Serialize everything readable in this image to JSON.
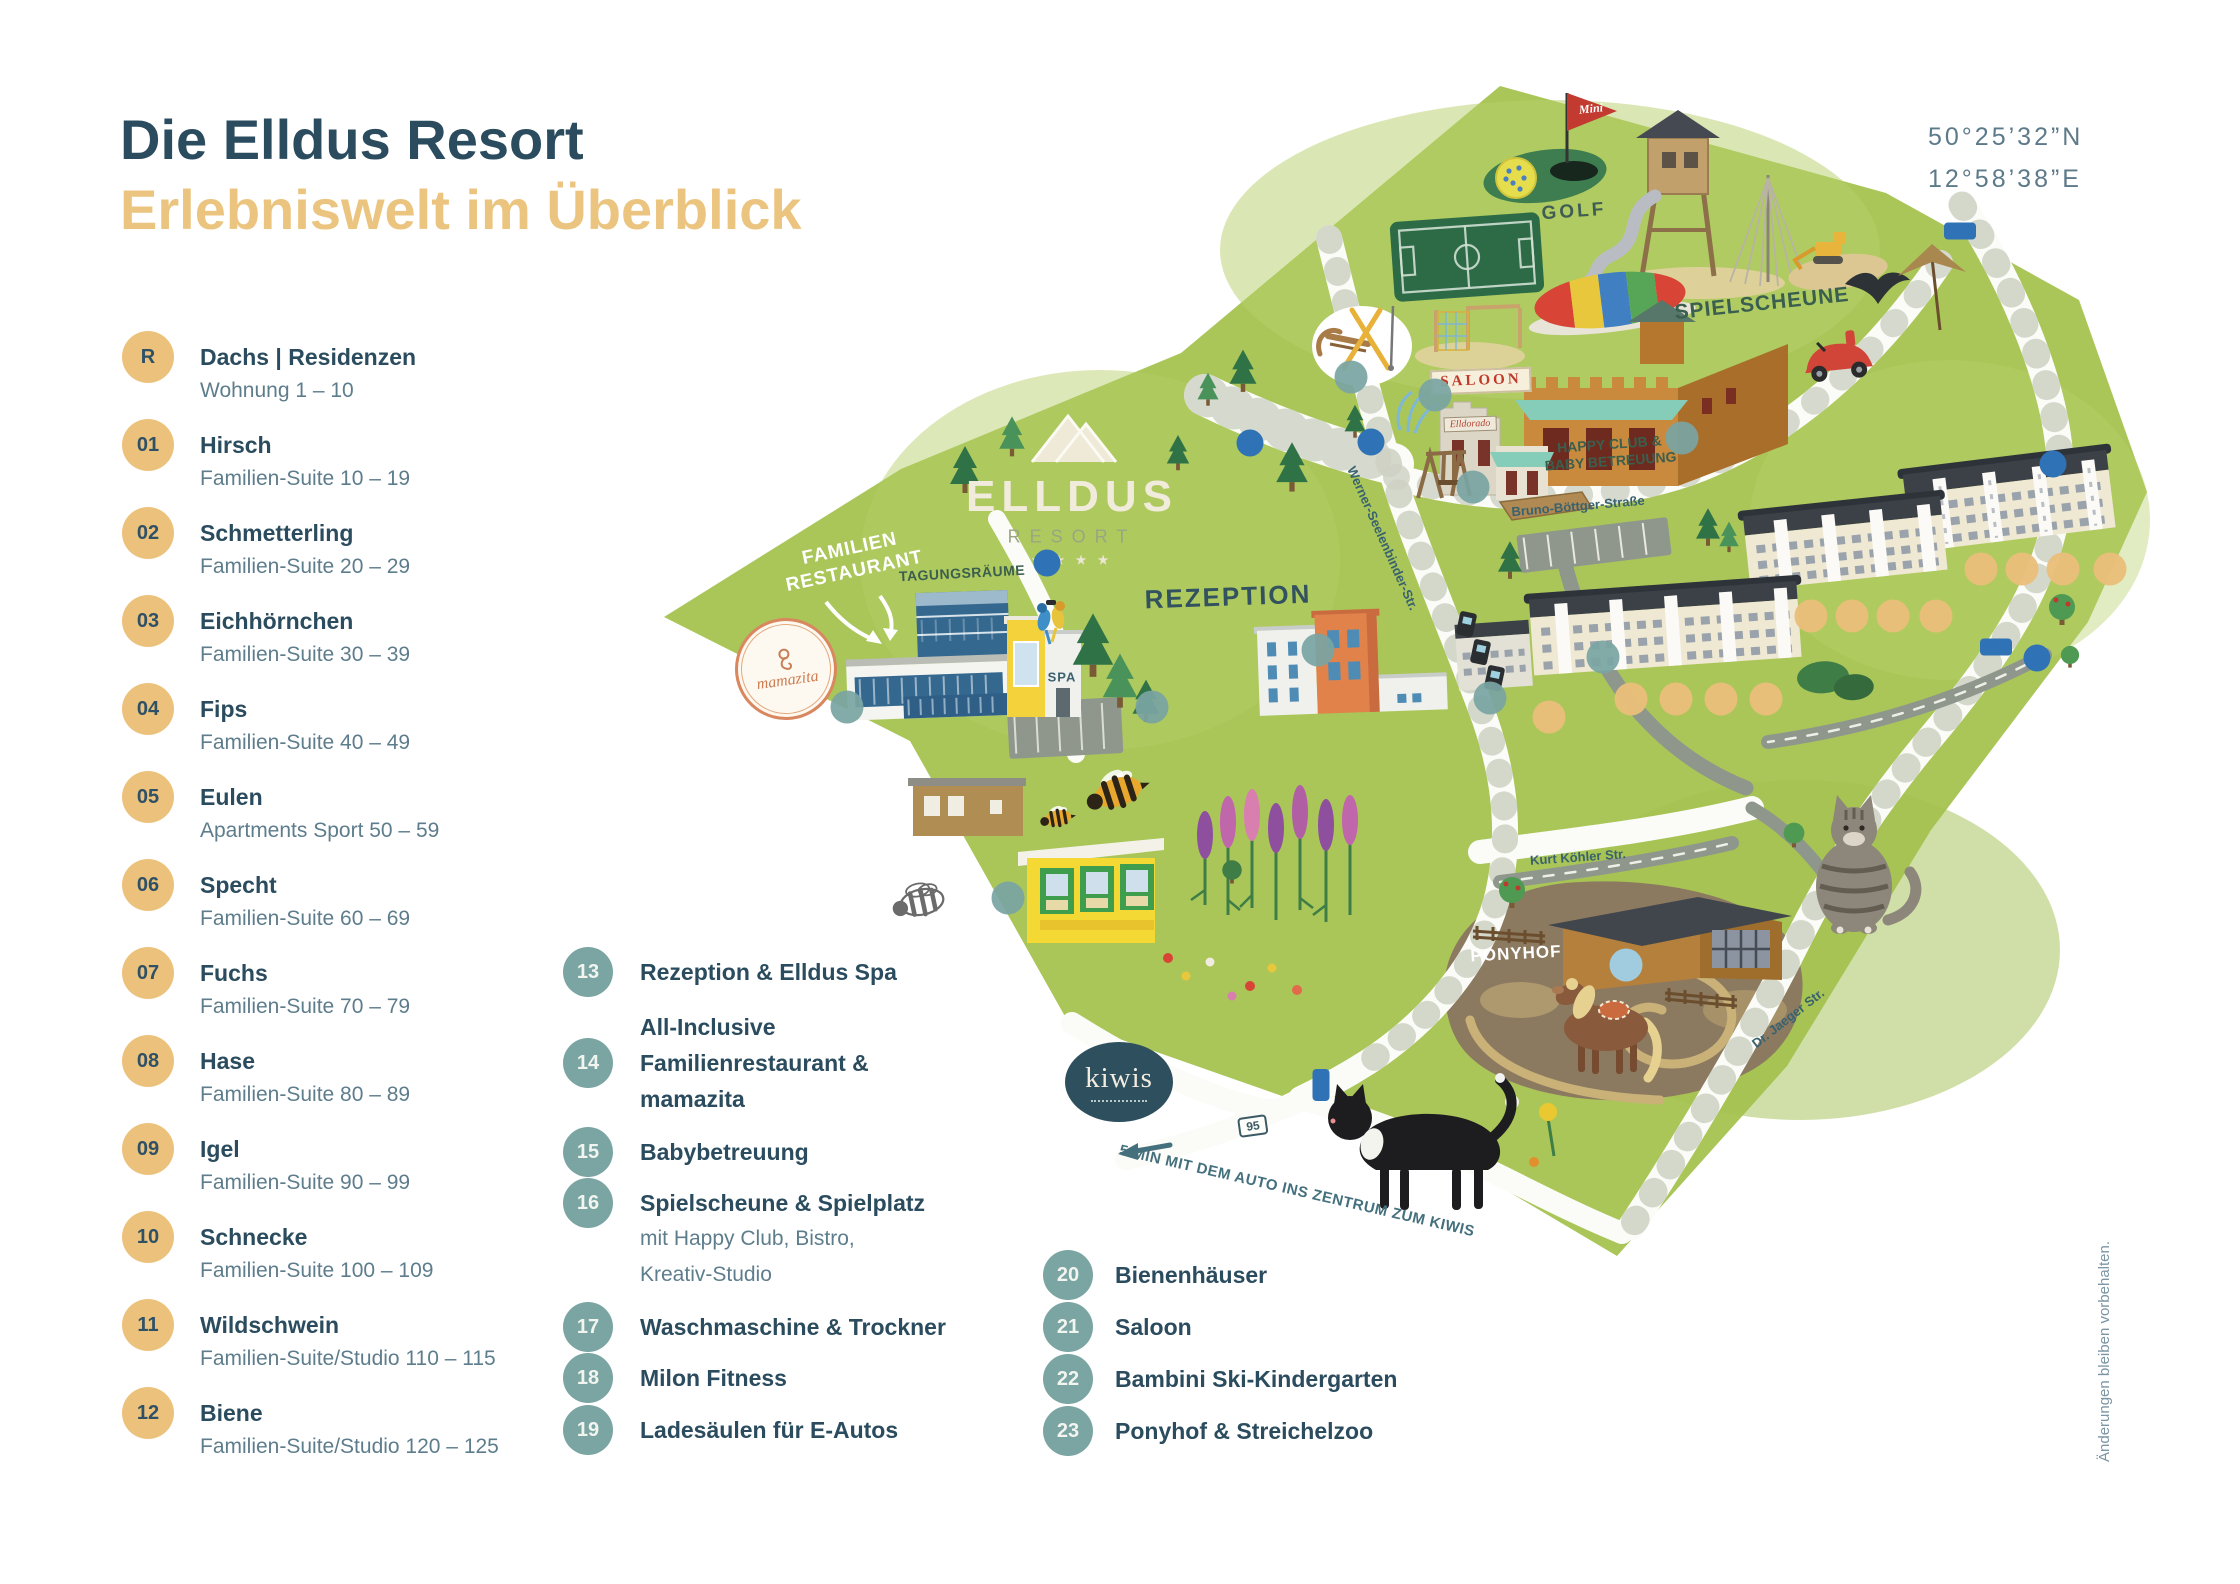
{
  "title": {
    "line1": "Die Elldus Resort",
    "line2": "Erlebniswelt im Überblick"
  },
  "coordinates": {
    "lat": "50°25’32”N",
    "lon": "12°58’38”E"
  },
  "footnote": "Änderungen bleiben vorbehalten.",
  "legend_rooms": [
    {
      "id": "R",
      "name": "Dachs | Residenzen",
      "sub": "Wohnung 1 – 10"
    },
    {
      "id": "01",
      "name": "Hirsch",
      "sub": "Familien-Suite 10 – 19"
    },
    {
      "id": "02",
      "name": "Schmetterling",
      "sub": "Familien-Suite 20 – 29"
    },
    {
      "id": "03",
      "name": "Eichhörnchen",
      "sub": "Familien-Suite 30 – 39"
    },
    {
      "id": "04",
      "name": "Fips",
      "sub": "Familien-Suite 40 – 49"
    },
    {
      "id": "05",
      "name": "Eulen",
      "sub": "Apartments Sport 50 – 59"
    },
    {
      "id": "06",
      "name": "Specht",
      "sub": "Familien-Suite 60 – 69"
    },
    {
      "id": "07",
      "name": "Fuchs",
      "sub": "Familien-Suite 70 – 79"
    },
    {
      "id": "08",
      "name": "Hase",
      "sub": "Familien-Suite 80 – 89"
    },
    {
      "id": "09",
      "name": "Igel",
      "sub": "Familien-Suite 90 – 99"
    },
    {
      "id": "10",
      "name": "Schnecke",
      "sub": "Familien-Suite 100 – 109"
    },
    {
      "id": "11",
      "name": "Wildschwein",
      "sub": "Familien-Suite/Studio 110 – 115"
    },
    {
      "id": "12",
      "name": "Biene",
      "sub": "Familien-Suite/Studio 120 – 125"
    }
  ],
  "legend_facilities": [
    {
      "id": "13",
      "lines": [
        "Rezeption & Elldus Spa"
      ]
    },
    {
      "id": "14",
      "lines": [
        "All-Inclusive",
        "Familienrestaurant &",
        "mamazita"
      ]
    },
    {
      "id": "15",
      "lines": [
        "Babybetreuung"
      ]
    },
    {
      "id": "16",
      "lines": [
        "Spielscheune & Spielplatz"
      ],
      "sublines": [
        "mit Happy Club, Bistro,",
        "Kreativ-Studio"
      ],
      "align": "first"
    },
    {
      "id": "17",
      "lines": [
        "Waschmaschine & Trockner"
      ]
    },
    {
      "id": "18",
      "lines": [
        "Milon Fitness"
      ]
    },
    {
      "id": "19",
      "lines": [
        "Ladesäulen für E-Autos"
      ]
    }
  ],
  "legend_points": [
    {
      "id": "20",
      "name": "Bienenhäuser"
    },
    {
      "id": "21",
      "name": "Saloon"
    },
    {
      "id": "22",
      "name": "Bambini Ski-Kindergarten"
    },
    {
      "id": "23",
      "name": "Ponyhof & Streichelzoo"
    }
  ],
  "map": {
    "logo": {
      "name": "ELLDUS",
      "sub": "RESORT",
      "stars": "★ ★ ★ ★"
    },
    "labels": {
      "golf": "GOLF",
      "spielscheune": "SPIELSCHEUNE",
      "tagungsraeume": "TAGUNGSRÄUME",
      "rezeption": "REZEPTION",
      "spa": "SPA",
      "ponyhof": "PONYHOF",
      "restaurant_line1": "FAMILIEN",
      "restaurant_line2": "RESTAURANT",
      "happy_line1": "HAPPY CLUB &",
      "happy_line2": "BABY BETREUUNG",
      "saloon": "SALOON",
      "elldorado": "Elldorado",
      "mini": "Mini",
      "kiwis": "kiwis",
      "mamazita": "mamazita",
      "note": "5 MIN MIT DEM AUTO INS ZENTRUM ZUM KIWIS",
      "route": "95"
    },
    "streets": {
      "bruno": "Bruno-Böttger-Straße",
      "werner": "Werner-Seelenbinder-Str.",
      "kurt": "Kurt Köhler Str.",
      "jaeger": "Dr. Jaeger Str."
    },
    "markers": [
      {
        "id": "R",
        "x": 1549,
        "y": 717,
        "kind": "g"
      },
      {
        "id": "01",
        "x": 1631,
        "y": 699,
        "kind": "g"
      },
      {
        "id": "02",
        "x": 1676,
        "y": 699,
        "kind": "g"
      },
      {
        "id": "03",
        "x": 1721,
        "y": 699,
        "kind": "g"
      },
      {
        "id": "04",
        "x": 1766,
        "y": 699,
        "kind": "g"
      },
      {
        "id": "05",
        "x": 1811,
        "y": 616,
        "kind": "g"
      },
      {
        "id": "06",
        "x": 1852,
        "y": 616,
        "kind": "g"
      },
      {
        "id": "07",
        "x": 1893,
        "y": 616,
        "kind": "g"
      },
      {
        "id": "08",
        "x": 1936,
        "y": 616,
        "kind": "g"
      },
      {
        "id": "09",
        "x": 1981,
        "y": 569,
        "kind": "g"
      },
      {
        "id": "10",
        "x": 2022,
        "y": 569,
        "kind": "g"
      },
      {
        "id": "11",
        "x": 2063,
        "y": 569,
        "kind": "g"
      },
      {
        "id": "12",
        "x": 2110,
        "y": 569,
        "kind": "g"
      },
      {
        "id": "13",
        "x": 1318,
        "y": 650,
        "kind": "t"
      },
      {
        "id": "14",
        "x": 847,
        "y": 707,
        "kind": "t"
      },
      {
        "id": "15",
        "x": 1473,
        "y": 487,
        "kind": "t"
      },
      {
        "id": "16",
        "x": 1682,
        "y": 438,
        "kind": "t"
      },
      {
        "id": "17",
        "x": 1603,
        "y": 657,
        "kind": "t"
      },
      {
        "id": "18",
        "x": 1152,
        "y": 707,
        "kind": "t"
      },
      {
        "id": "19",
        "x": 1490,
        "y": 698,
        "kind": "t"
      },
      {
        "id": "20",
        "x": 1008,
        "y": 898,
        "kind": "t"
      },
      {
        "id": "21",
        "x": 1435,
        "y": 395,
        "kind": "t"
      },
      {
        "id": "22",
        "x": 1351,
        "y": 377,
        "kind": "t"
      },
      {
        "id": "23",
        "x": 1626,
        "y": 965,
        "kind": "b"
      }
    ],
    "parking": [
      {
        "x": 1250,
        "y": 443,
        "label": "P"
      },
      {
        "x": 1371,
        "y": 442,
        "label": "P"
      },
      {
        "x": 1047,
        "y": 563,
        "label": "P"
      },
      {
        "x": 2053,
        "y": 464,
        "label": "P"
      },
      {
        "x": 2037,
        "y": 658,
        "label": "P"
      }
    ],
    "arrows": [
      {
        "x": 1960,
        "y": 231,
        "glyph": "←"
      },
      {
        "x": 1996,
        "y": 647,
        "glyph": "←"
      },
      {
        "x": 1321,
        "y": 1085,
        "glyph": "↓",
        "vert": true
      }
    ]
  },
  "colors": {
    "accent_gold": "#ecc17c",
    "accent_teal": "#7aa5a2",
    "ink": "#2b4c5e",
    "map_green": "#aac659",
    "marker_blue": "#a0cfe7"
  }
}
